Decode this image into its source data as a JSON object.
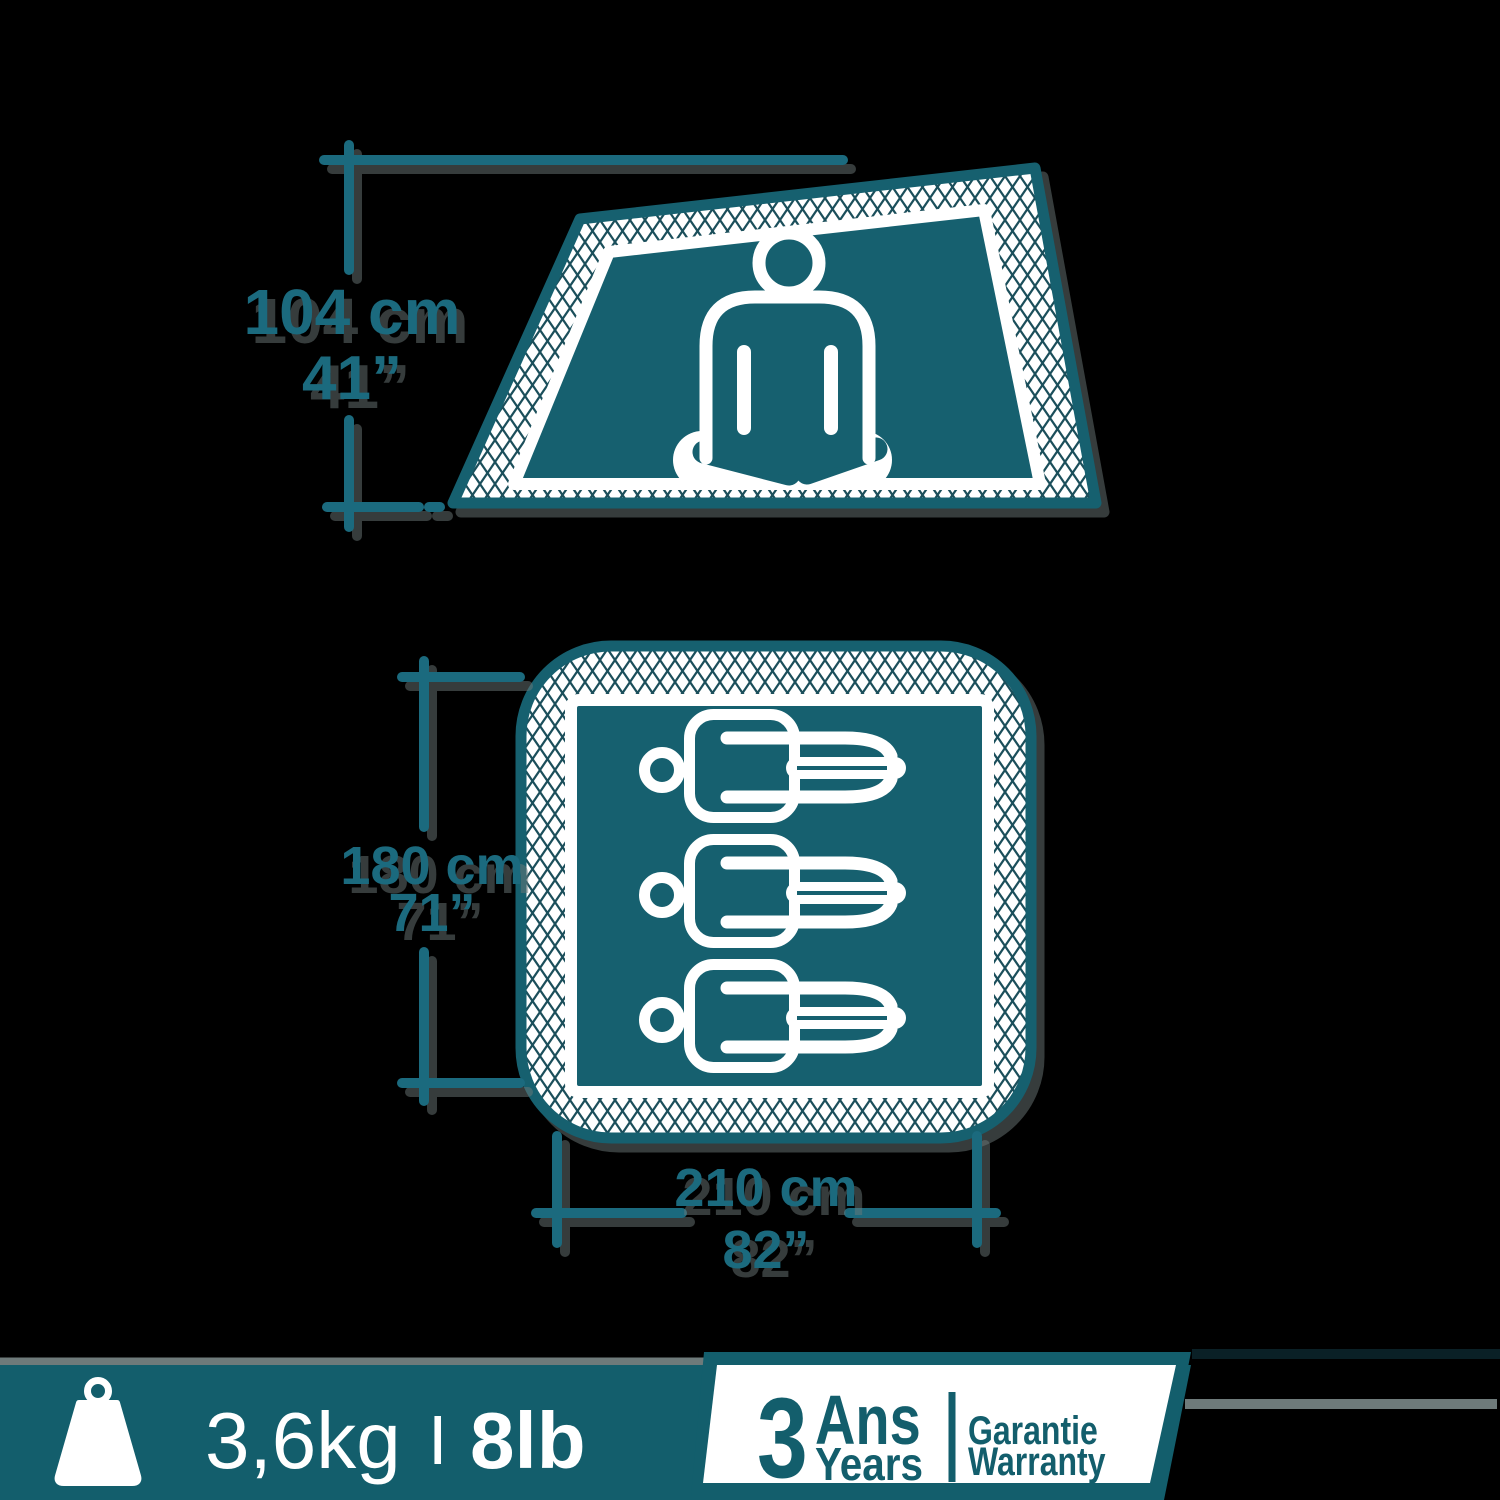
{
  "colors": {
    "background": "#000000",
    "teal_primary": "#16606f",
    "teal_dims": "#1b6a7e",
    "mesh_line": "#1b4f5b",
    "white": "#ffffff",
    "shadow_gray": "#6e7a7a",
    "banner_teal": "#135e6c"
  },
  "tent_side_view": {
    "description": "tent side view with seated meditating person",
    "height": {
      "metric": "104 cm",
      "imperial": "41”"
    }
  },
  "floor_plan": {
    "description": "tent floor plan with three lying sleepers",
    "capacity": 3,
    "width": {
      "metric": "180 cm",
      "imperial": "71”"
    },
    "length": {
      "metric": "210 cm",
      "imperial": "82”"
    }
  },
  "weight_bar": {
    "metric": "3,6kg",
    "separator": "I",
    "imperial": "8lb"
  },
  "warranty_badge": {
    "duration": "3",
    "unit_fr": "Ans",
    "unit_en": "Years",
    "word_fr": "Garantie",
    "word_en": "Warranty"
  }
}
